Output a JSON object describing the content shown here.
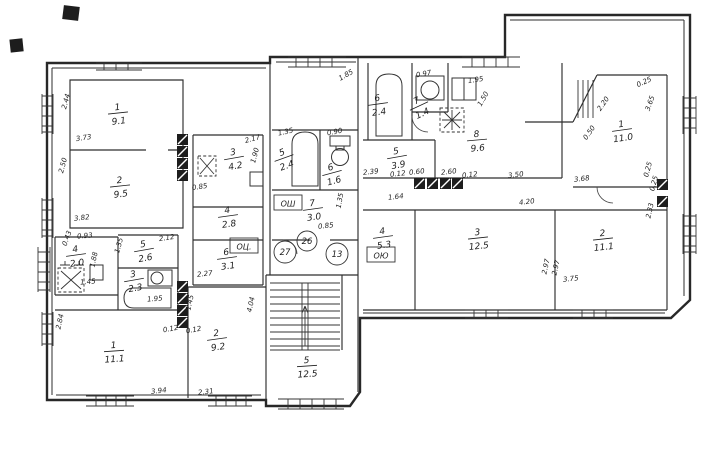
{
  "drawing": {
    "type": "scanned-floor-plan",
    "colors": {
      "ink": "#2e2e2e",
      "paper": "#ffffff"
    },
    "rooms": [
      {
        "num": "1",
        "area": "9.1",
        "x": 118,
        "y": 113,
        "rot": -6
      },
      {
        "num": "2",
        "area": "9.5",
        "x": 120,
        "y": 186,
        "rot": -6
      },
      {
        "num": "3",
        "area": "4.2",
        "x": 234,
        "y": 158,
        "rot": -10
      },
      {
        "num": "4",
        "area": "2.8",
        "x": 228,
        "y": 216,
        "rot": -8
      },
      {
        "num": "6",
        "area": "3.1",
        "x": 227,
        "y": 258,
        "rot": -8
      },
      {
        "num": "4",
        "area": "2.0",
        "x": 76,
        "y": 255,
        "rot": -8
      },
      {
        "num": "5",
        "area": "2.6",
        "x": 144,
        "y": 250,
        "rot": -10
      },
      {
        "num": "3",
        "area": "2.3",
        "x": 134,
        "y": 280,
        "rot": -10
      },
      {
        "num": "1",
        "area": "11.1",
        "x": 114,
        "y": 351,
        "rot": -4
      },
      {
        "num": "2",
        "area": "9.2",
        "x": 217,
        "y": 339,
        "rot": -8
      },
      {
        "num": "5",
        "area": "12.5",
        "x": 307,
        "y": 366,
        "rot": -4
      },
      {
        "num": "5",
        "area": "2.4",
        "x": 284,
        "y": 158,
        "rot": -20
      },
      {
        "num": "6",
        "area": "1.6",
        "x": 332,
        "y": 173,
        "rot": -15
      },
      {
        "num": "7",
        "area": "3.0",
        "x": 313,
        "y": 209,
        "rot": -8
      },
      {
        "num": "6",
        "area": "2.4",
        "x": 378,
        "y": 104,
        "rot": -8
      },
      {
        "num": "7",
        "area": "1.4",
        "x": 419,
        "y": 106,
        "rot": -25
      },
      {
        "num": "8",
        "area": "9.6",
        "x": 477,
        "y": 140,
        "rot": -5
      },
      {
        "num": "5",
        "area": "3.9",
        "x": 397,
        "y": 157,
        "rot": -10
      },
      {
        "num": "4",
        "area": "5.3",
        "x": 383,
        "y": 237,
        "rot": -8
      },
      {
        "num": "3",
        "area": "12.5",
        "x": 478,
        "y": 238,
        "rot": -6
      },
      {
        "num": "2",
        "area": "11.1",
        "x": 603,
        "y": 239,
        "rot": -6
      },
      {
        "num": "1",
        "area": "11.0",
        "x": 622,
        "y": 130,
        "rot": -8
      }
    ],
    "dimensions": [
      {
        "text": "2.44",
        "x": 68,
        "y": 102,
        "rot": -75
      },
      {
        "text": "3.73",
        "x": 84,
        "y": 140,
        "rot": -8
      },
      {
        "text": "2.50",
        "x": 65,
        "y": 166,
        "rot": -75
      },
      {
        "text": "3.82",
        "x": 82,
        "y": 220,
        "rot": -6
      },
      {
        "text": "2.17",
        "x": 253,
        "y": 141,
        "rot": -15
      },
      {
        "text": "1.90",
        "x": 257,
        "y": 156,
        "rot": -75
      },
      {
        "text": "0.85",
        "x": 200,
        "y": 189,
        "rot": -8
      },
      {
        "text": "2.27",
        "x": 205,
        "y": 276,
        "rot": -6
      },
      {
        "text": "0.43",
        "x": 69,
        "y": 239,
        "rot": -70
      },
      {
        "text": "0.93",
        "x": 85,
        "y": 238,
        "rot": -5
      },
      {
        "text": "1.88",
        "x": 96,
        "y": 260,
        "rot": -78
      },
      {
        "text": "1.45",
        "x": 88,
        "y": 284,
        "rot": -5
      },
      {
        "text": "2.12",
        "x": 167,
        "y": 240,
        "rot": -8
      },
      {
        "text": "1.35",
        "x": 121,
        "y": 246,
        "rot": -75
      },
      {
        "text": "1.95",
        "x": 155,
        "y": 301,
        "rot": -5
      },
      {
        "text": "2.84",
        "x": 62,
        "y": 322,
        "rot": -78
      },
      {
        "text": "3.94",
        "x": 159,
        "y": 393,
        "rot": -6
      },
      {
        "text": "2.31",
        "x": 206,
        "y": 394,
        "rot": -6
      },
      {
        "text": "4.04",
        "x": 253,
        "y": 305,
        "rot": -78
      },
      {
        "text": "1.45",
        "x": 192,
        "y": 303,
        "rot": -78
      },
      {
        "text": "0.12",
        "x": 171,
        "y": 331,
        "rot": -10
      },
      {
        "text": "0.12",
        "x": 194,
        "y": 332,
        "rot": -10
      },
      {
        "text": "1.35",
        "x": 286,
        "y": 134,
        "rot": -12
      },
      {
        "text": "0.90",
        "x": 335,
        "y": 134,
        "rot": -10
      },
      {
        "text": "0.85",
        "x": 326,
        "y": 228,
        "rot": -6
      },
      {
        "text": "1.35",
        "x": 342,
        "y": 201,
        "rot": -80
      },
      {
        "text": "1.85",
        "x": 347,
        "y": 77,
        "rot": -30
      },
      {
        "text": "0.97",
        "x": 424,
        "y": 76,
        "rot": -10
      },
      {
        "text": "1.95",
        "x": 476,
        "y": 82,
        "rot": -8
      },
      {
        "text": "1.50",
        "x": 485,
        "y": 100,
        "rot": -60
      },
      {
        "text": "2.39",
        "x": 371,
        "y": 174,
        "rot": -6
      },
      {
        "text": "0.12",
        "x": 398,
        "y": 176,
        "rot": -6
      },
      {
        "text": "0.60",
        "x": 417,
        "y": 174,
        "rot": -6
      },
      {
        "text": "2.60",
        "x": 449,
        "y": 174,
        "rot": -6
      },
      {
        "text": "0.12",
        "x": 470,
        "y": 177,
        "rot": -6
      },
      {
        "text": "3.50",
        "x": 516,
        "y": 177,
        "rot": -6
      },
      {
        "text": "1.64",
        "x": 396,
        "y": 199,
        "rot": -6
      },
      {
        "text": "4.20",
        "x": 527,
        "y": 204,
        "rot": -6
      },
      {
        "text": "3.68",
        "x": 582,
        "y": 181,
        "rot": -6
      },
      {
        "text": "2.97",
        "x": 548,
        "y": 267,
        "rot": -78
      },
      {
        "text": "2.97",
        "x": 558,
        "y": 268,
        "rot": -78
      },
      {
        "text": "3.75",
        "x": 571,
        "y": 281,
        "rot": -6
      },
      {
        "text": "2.33",
        "x": 652,
        "y": 211,
        "rot": -78
      },
      {
        "text": "0.25",
        "x": 645,
        "y": 84,
        "rot": -25
      },
      {
        "text": "3.65",
        "x": 652,
        "y": 104,
        "rot": -70
      },
      {
        "text": "2.20",
        "x": 605,
        "y": 105,
        "rot": -55
      },
      {
        "text": "0.50",
        "x": 591,
        "y": 134,
        "rot": -55
      },
      {
        "text": "0.25",
        "x": 650,
        "y": 170,
        "rot": -75
      },
      {
        "text": "0.25",
        "x": 656,
        "y": 184,
        "rot": -75
      }
    ],
    "circled_labels": [
      {
        "text": "27",
        "x": 285,
        "y": 252,
        "r": 11
      },
      {
        "text": "26",
        "x": 307,
        "y": 241,
        "r": 10
      },
      {
        "text": "13",
        "x": 337,
        "y": 254,
        "r": 11
      }
    ],
    "boxed_labels": [
      {
        "text": "ОШ",
        "x": 288,
        "y": 203
      },
      {
        "text": "ОЦ.",
        "x": 244,
        "y": 246
      },
      {
        "text": "ОЮ",
        "x": 381,
        "y": 255
      }
    ]
  }
}
